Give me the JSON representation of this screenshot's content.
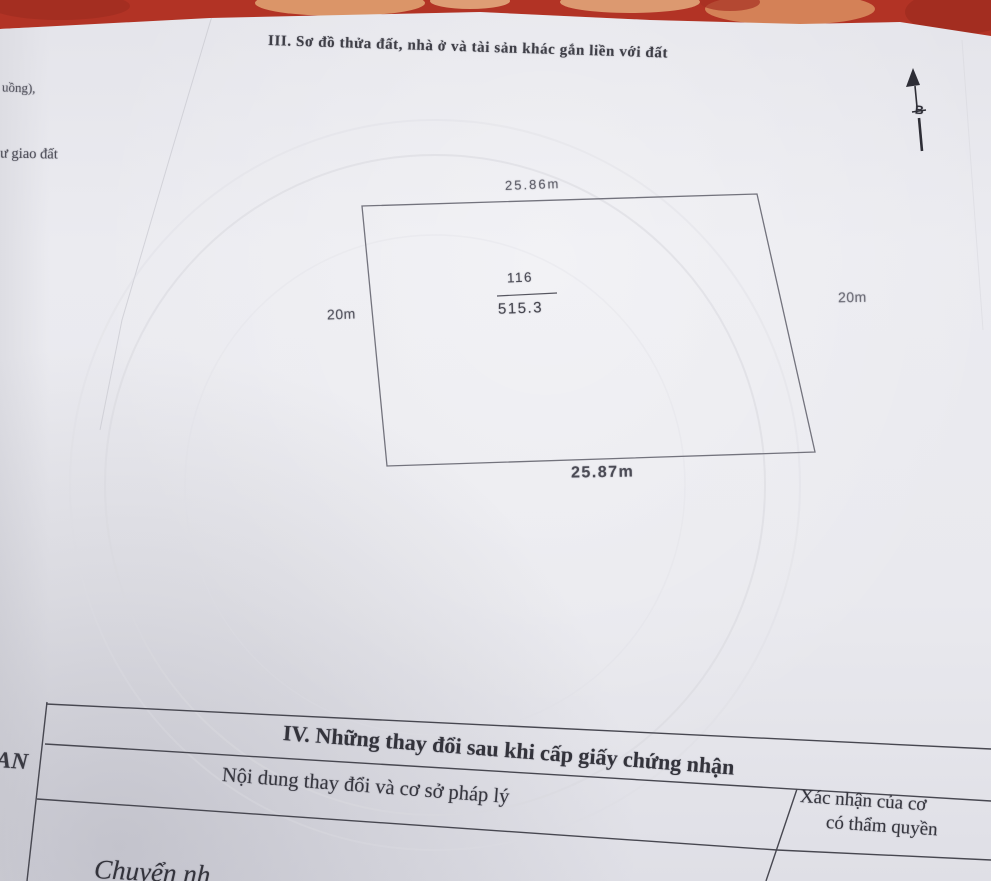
{
  "section3": {
    "title": "III. Sơ đồ thửa đất, nhà ở và tài sản khác gắn liền với đất"
  },
  "margin": {
    "fragment_top": "uồng),",
    "fragment_middle": "ư giao đất",
    "fragment_bottom": "AN"
  },
  "compass": {
    "label": "B"
  },
  "plot": {
    "edge_top": "25.86m",
    "edge_left": "20m",
    "edge_right": "20m",
    "edge_bottom": "25.87m",
    "parcel_number": "116",
    "area": "515.3"
  },
  "section4": {
    "title": "IV. Những thay đổi sau khi cấp giấy chứng nhận",
    "col1_header": "Nội dung thay đổi và cơ sở pháp lý",
    "col2_header_line1": "Xác nhận của cơ",
    "col2_header_line2": "có thẩm quyền",
    "entry_partial": "Chuyển nh"
  },
  "colors": {
    "tablecloth_red": "#b23325",
    "page_gray": "#e9e9ee",
    "ink": "#3c3c44",
    "diagram_line": "#73737d"
  }
}
